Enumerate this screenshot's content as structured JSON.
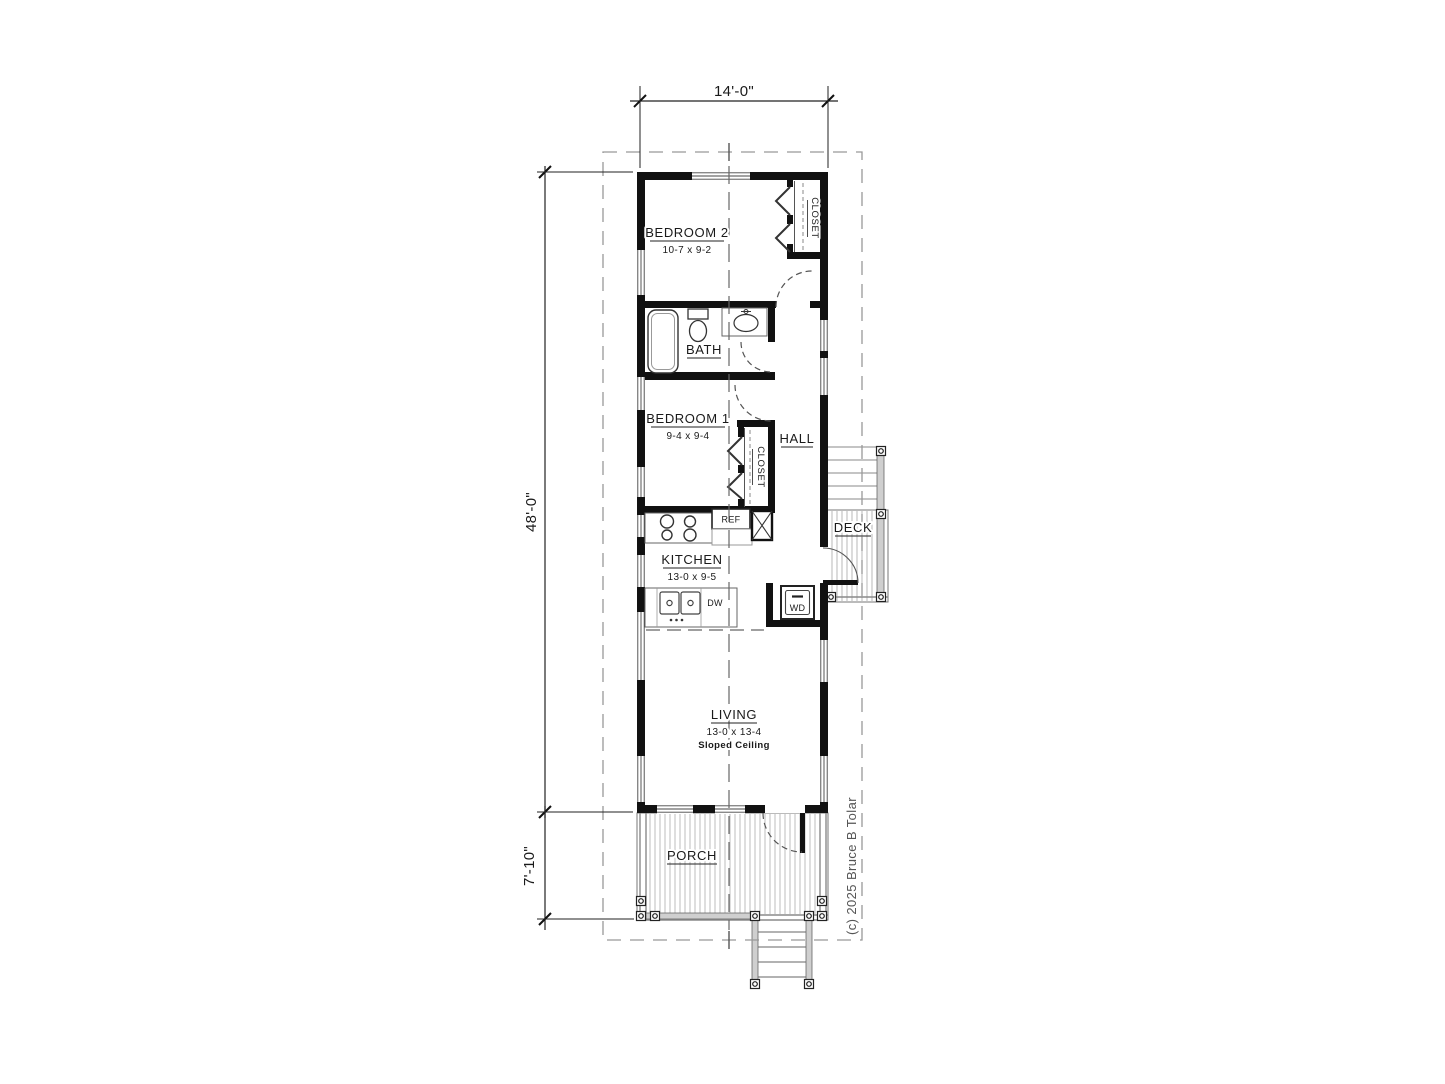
{
  "drawing": {
    "dimensions": {
      "width_top": "14'-0\"",
      "height_main": "48'-0\"",
      "height_porch": "7'-10\""
    },
    "rooms": {
      "bedroom2": {
        "name": "BEDROOM 2",
        "size": "10-7 x 9-2"
      },
      "bedroom1": {
        "name": "BEDROOM 1",
        "size": "9-4 x 9-4"
      },
      "bath": {
        "name": "BATH"
      },
      "hall": {
        "name": "HALL"
      },
      "kitchen": {
        "name": "KITCHEN",
        "size": "13-0 x 9-5"
      },
      "living": {
        "name": "LIVING",
        "size": "13-0 x 13-4",
        "note": "Sloped  Ceiling"
      },
      "porch": {
        "name": "PORCH"
      },
      "deck": {
        "name": "DECK"
      },
      "closet_bedroom2": {
        "name": "CLOSET"
      },
      "closet_bedroom1": {
        "name": "CLOSET"
      }
    },
    "appliances": {
      "refrigerator": "REF",
      "dishwasher": "DW",
      "washer_dryer": "WD"
    },
    "copyright": "(c) 2025 Bruce B Tolar",
    "colors": {
      "wall": "#111111",
      "line": "#222222",
      "gray": "#888888",
      "light_gray": "#bbbbbb",
      "background": "#ffffff"
    }
  }
}
